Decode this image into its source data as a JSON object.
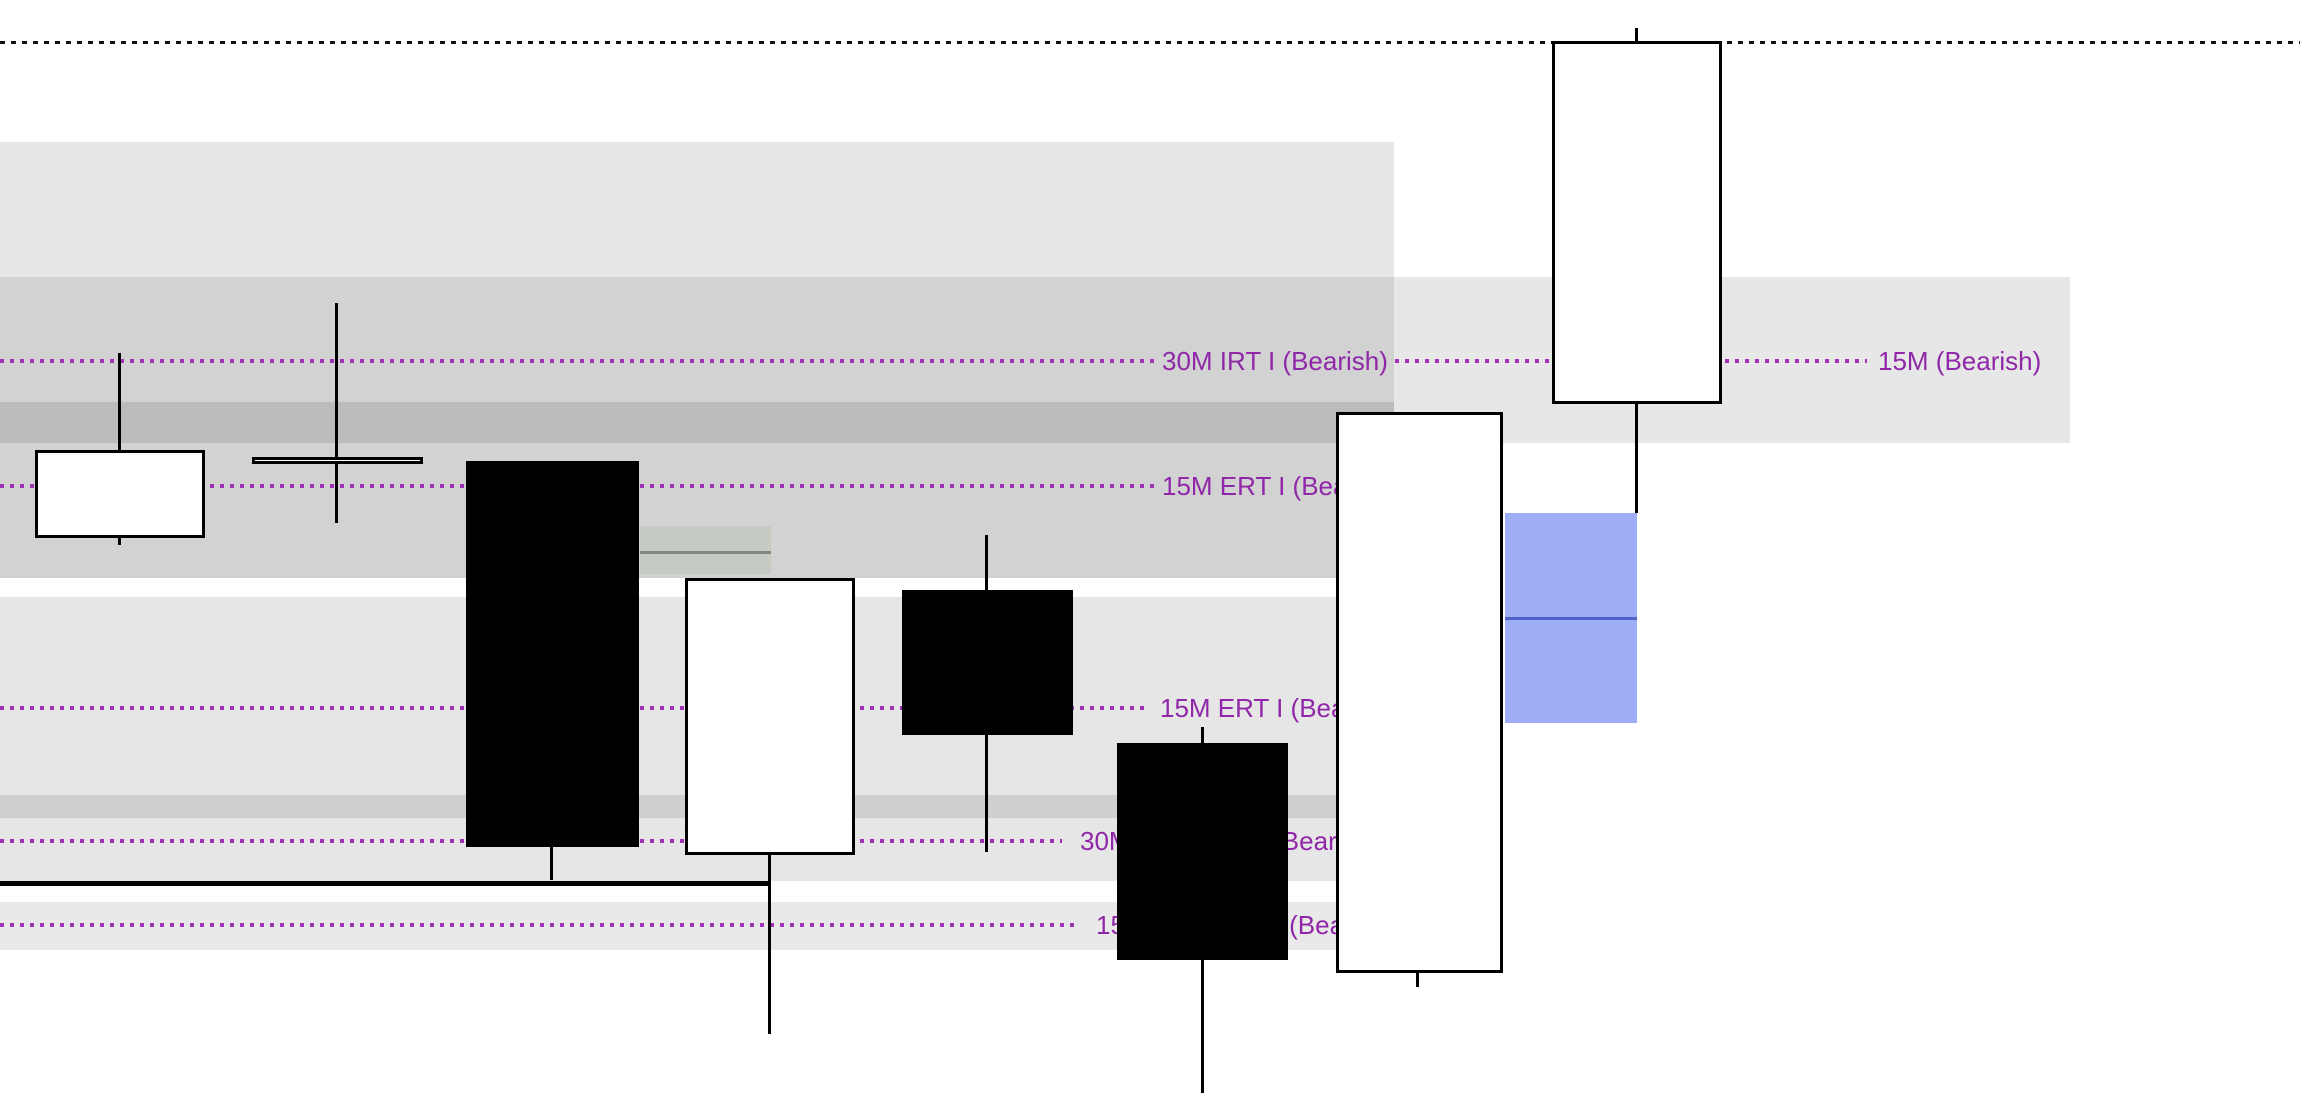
{
  "chart_data": {
    "type": "candlestick",
    "canvas": {
      "width": 2300,
      "height": 1120,
      "background": "#ffffff"
    },
    "colors": {
      "level_line": "#9e32b8",
      "level_text": "#8f27a8",
      "top_dotted_line": "#111111",
      "solid_price_line": "#000000",
      "candle_up_fill": "#ffffff",
      "candle_down_fill": "#000000",
      "candle_border": "#000000"
    },
    "zones": [
      {
        "name": "supply-zone-top",
        "x": 0,
        "y": 142,
        "w": 1394,
        "h": 135,
        "color": "#e7e7e7"
      },
      {
        "name": "supply-zone-15m-right",
        "x": 1394,
        "y": 277,
        "w": 676,
        "h": 166,
        "color": "#e7e7e7"
      },
      {
        "name": "supply-zone-overlap-upper",
        "x": 0,
        "y": 277,
        "w": 1394,
        "h": 125,
        "color": "#d2d2d2"
      },
      {
        "name": "supply-zone-overlap-dark",
        "x": 0,
        "y": 402,
        "w": 1394,
        "h": 41,
        "color": "#bcbcbc"
      },
      {
        "name": "supply-zone-overlap-lower",
        "x": 0,
        "y": 443,
        "w": 1394,
        "h": 135,
        "color": "#d2d2d2"
      },
      {
        "name": "supply-zone-mid",
        "x": 0,
        "y": 597,
        "w": 1394,
        "h": 284,
        "color": "#e6e6e6"
      },
      {
        "name": "supply-zone-mid-dark-strip",
        "x": 0,
        "y": 795,
        "w": 1394,
        "h": 23,
        "color": "#cfcfcf"
      },
      {
        "name": "supply-zone-low",
        "x": 0,
        "y": 902,
        "w": 1394,
        "h": 48,
        "color": "#e9e9e9"
      },
      {
        "name": "demand-zone-green",
        "x": 640,
        "y": 526,
        "w": 131,
        "h": 48,
        "color": "#c6ccc4",
        "line_y": 551,
        "line_color": "#7e8b7e",
        "line_h": 3
      },
      {
        "name": "blue-zone",
        "x": 1505,
        "y": 513,
        "w": 132,
        "h": 210,
        "color": "#9dadf6",
        "line_y": 617,
        "line_color": "#5063c4",
        "line_h": 3
      }
    ],
    "levels": [
      {
        "y": 361,
        "segments": [
          {
            "x1": 0,
            "x2": 1157
          },
          {
            "x1": 1395,
            "x2": 1867
          }
        ],
        "labels": [
          {
            "text": "30M IRT I (Bearish)",
            "x": 1162
          },
          {
            "text": "15M (Bearish)",
            "x": 1878
          }
        ]
      },
      {
        "y": 486,
        "segments": [
          {
            "x1": 0,
            "x2": 1155
          }
        ],
        "labels": [
          {
            "text": "15M ERT I (Bearish)",
            "x": 1162
          }
        ]
      },
      {
        "y": 708,
        "segments": [
          {
            "x1": 0,
            "x2": 1150
          }
        ],
        "labels": [
          {
            "text": "15M ERT I (Bearish)",
            "x": 1160
          }
        ]
      },
      {
        "y": 841,
        "segments": [
          {
            "x1": 0,
            "x2": 1062
          }
        ],
        "labels": [
          {
            "text": "30M IRT I ERT I (Bearish)",
            "x": 1080
          }
        ]
      },
      {
        "y": 925,
        "segments": [
          {
            "x1": 0,
            "x2": 1078
          }
        ],
        "labels": [
          {
            "text": "15M IRT I ERT I (Bearish)",
            "x": 1096
          }
        ]
      }
    ],
    "extra_lines": [
      {
        "name": "top-dotted-line",
        "y": 42,
        "x1": 0,
        "x2": 2300,
        "style": "dotted",
        "thickness": 3,
        "color": "#111111"
      },
      {
        "name": "solid-price-line",
        "y": 883,
        "x1": 0,
        "x2": 768,
        "style": "solid",
        "thickness": 5,
        "color": "#000000"
      }
    ],
    "candles": [
      {
        "x": 35,
        "w": 170,
        "body_top": 450,
        "body_bottom": 538,
        "dir": "white",
        "wick_x": 119,
        "wick_top": 353,
        "wick_bottom": 545
      },
      {
        "x": 252,
        "w": 171,
        "body_top": 457,
        "body_bottom": 464,
        "dir": "white",
        "wick_x": 336,
        "wick_top": 303,
        "wick_bottom": 523
      },
      {
        "x": 466,
        "w": 173,
        "body_top": 461,
        "body_bottom": 847,
        "dir": "black",
        "wick_x": 551,
        "wick_top": 461,
        "wick_bottom": 880
      },
      {
        "x": 685,
        "w": 170,
        "body_top": 578,
        "body_bottom": 855,
        "dir": "white",
        "wick_x": 769,
        "wick_top": 578,
        "wick_bottom": 1034
      },
      {
        "x": 902,
        "w": 171,
        "body_top": 590,
        "body_bottom": 735,
        "dir": "black",
        "wick_x": 986,
        "wick_top": 535,
        "wick_bottom": 852
      },
      {
        "x": 1117,
        "w": 171,
        "body_top": 743,
        "body_bottom": 960,
        "dir": "black",
        "wick_x": 1202,
        "wick_top": 727,
        "wick_bottom": 1093
      },
      {
        "x": 1336,
        "w": 167,
        "body_top": 412,
        "body_bottom": 973,
        "dir": "white",
        "wick_x": 1417,
        "wick_top": 412,
        "wick_bottom": 987
      },
      {
        "x": 1552,
        "w": 170,
        "body_top": 41,
        "body_bottom": 404,
        "dir": "white",
        "wick_x": 1636,
        "wick_top": 28,
        "wick_bottom": 513
      }
    ]
  }
}
